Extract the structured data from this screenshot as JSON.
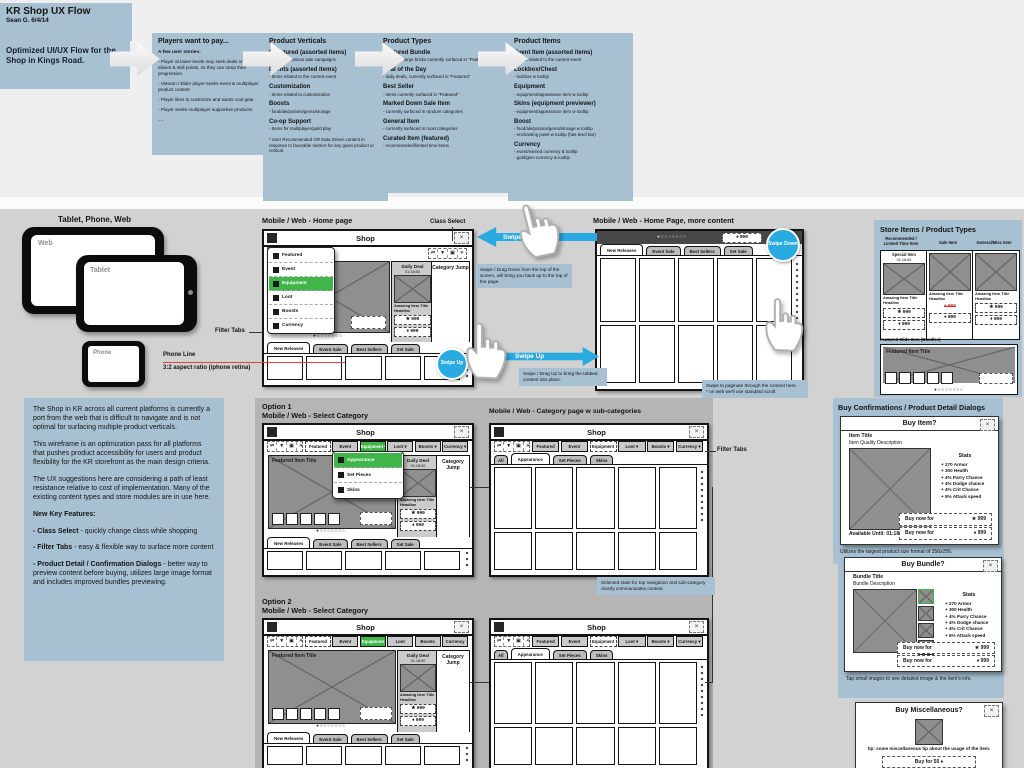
{
  "header": {
    "title": "KR Shop UX Flow",
    "byline": "Sean G.   6/4/14",
    "subtitle": "Optimized UI/UX Flow for the Shop in Kings Road."
  },
  "flow": {
    "players": {
      "heading": "Players want to pay...",
      "subheading": "A few user stories:",
      "stories": [
        "- Player at lower levels may seek deals on inventory, elixers & skill points, so they can ramp their progression.",
        "- Veteran / Elder player seeks event & multiplayer product content",
        "- Player likes to customize and wants cool gear",
        "- Player seeks multiplayer supportive products.",
        "....."
      ]
    },
    "verticals": {
      "heading": "Product Verticals",
      "entries": [
        {
          "title": "* Featured (assorted items)",
          "desc": "- Items for various sale campaigns"
        },
        {
          "title": "Events (assorted items)",
          "desc": "- Items related to the current event"
        },
        {
          "title": "Customization",
          "desc": "- Items related to customization"
        },
        {
          "title": "Boosts",
          "desc": "- food/ale/potions/gems/storage"
        },
        {
          "title": "Co-op Support",
          "desc": "- Items for multiplayer/guild play"
        }
      ],
      "footnote": "* User Recommended OR Data Driven content in response to favorable metrics for any given product or vertical."
    },
    "types": {
      "heading": "Product Types",
      "entries": [
        {
          "title": "Featured Bundle",
          "desc": "- Slides of large bricks currently surfaced in \"Featured\""
        },
        {
          "title": "Deal of the Day",
          "desc": "- daily deals, currently surfaced in \"Featured\""
        },
        {
          "title": "Best Seller",
          "desc": "- items currently surfaced in \"Featured\""
        },
        {
          "title": "Marked Down Sale Item",
          "desc": "- currently surfaced in random categories"
        },
        {
          "title": "General Item",
          "desc": "- currently surfaced in most categories"
        },
        {
          "title": "Curated Item (featured)",
          "desc": "- recommended/limited time items"
        }
      ]
    },
    "items": {
      "heading": "Product Items",
      "entries": [
        {
          "title": "Event Item (assorted items)",
          "desc": "- Items related to the current event"
        },
        {
          "title": "Lockbox/Chest",
          "desc": "- lockbox w tooltip"
        },
        {
          "title": "Equipment",
          "desc": "- equipment/appearance item w tooltip"
        },
        {
          "title": "Skins (equipment previewer)",
          "desc": "- equipment/appearance item w tooltip"
        },
        {
          "title": "Boost",
          "desc": "- food/ale/potions/gems/storage w tooltip\n- enchanting jewel w tooltip (has level bar)"
        },
        {
          "title": "Currency",
          "desc": "- event/earned currency & tooltip\n- gold/gem currency & tooltip"
        }
      ]
    }
  },
  "intro": {
    "p1": "The Shop in KR across all current platforms is currently a port from the web that is difficult to navigate and is not optimal for surfacing multiple product verticals.",
    "p2": "This wireframe is an optimization pass for all platforms that pushes product accessibility for users and product flexibility for the KR storefront as the main design criteria.",
    "p3": "The UX suggestions here are considering a path of least resistance relative to cost of implementation. Many of the existing content types and store modules are in use here.",
    "features_heading": "New Key Features:",
    "features": [
      {
        "head": "- Class Select",
        "rest": " - quickly change class while shopping"
      },
      {
        "head": "- Filter Tabs",
        "rest": " - easy & flexible way to surface more content"
      },
      {
        "head": "- Product Detail / Confirmation Dialogs",
        "rest": " - better way to preview content before buying, utilizes large image format and includes improved bundles previewing."
      }
    ]
  },
  "devices": {
    "heading": "Tablet, Phone, Web",
    "web": "Web",
    "tablet": "Tablet",
    "phone": "Phone"
  },
  "sections": {
    "homepage": "Mobile / Web - Home page",
    "more_content": "Mobile / Web - Home Page, more content",
    "option1": "Option 1",
    "option2": "Option 2",
    "select_category": "Mobile / Web - Select Category",
    "category_page": "Mobile / Web - Category page w sub-categories"
  },
  "annotations": {
    "class_select": "Class Select",
    "filter_tabs": "Filter Tabs",
    "phone_line": "Phone Line",
    "aspect_ratio": "3:2 aspect ratio (iphone retina)",
    "swipe_down": "Swipe Down",
    "swipe_up": "Swipe Up",
    "swipe_down_caption": "Swipe / Drag Down from the top of the screen, will bring you back up to the top of the page.",
    "swipe_up_caption": "Swipe / Drag Up to bring the tabbed content into place.",
    "paginate_caption": "Swipe to paginate through the content here.\n* on web we'll use standard scroll.",
    "selected_caption": "Selected state for top navigation and sub-category clearly communicates context."
  },
  "wireframe": {
    "shop": "Shop",
    "close": "×",
    "featured": "Featured",
    "category_jump": "Category Jump",
    "featured_item_title": "Featured Item Title",
    "daily_deal": "Daily Deal",
    "timer": "01:18:50",
    "amazing": "Amazing Item Title\nHeadline",
    "price_star": "★ 999",
    "price_gem": "♦ 999",
    "badge": "♦ 999",
    "dots": "●○○○○○○○",
    "caret": "▾",
    "filter_tabs": [
      "New Releases",
      "Event Sale",
      "Best Sellers",
      "Set Sale"
    ],
    "nav_tabs": [
      "Featured",
      "Event",
      "Equipment",
      "Loot",
      "Boosts",
      "Currency"
    ],
    "sub_tabs": [
      "All",
      "Appearance",
      "Set Pieces",
      "Skins"
    ],
    "equip_menu": [
      "Appearance",
      "Set Pieces",
      "Skins"
    ],
    "class_icons": [
      "⇄",
      "▼",
      "▣",
      "✳"
    ],
    "swipe_up_circle": "Swipe Up",
    "swipe_down_circle": "Swipe Down"
  },
  "store": {
    "heading": "Store Items / Product Types",
    "col_labels": [
      "Recommended /\nLimited Time Item",
      "Sale Item",
      "General/Misc Item"
    ],
    "special_item": "Special Item",
    "timer": "01:18:50",
    "item_title": "Amazing Item Title\nHeadline",
    "price_star": "★ 999",
    "price_gem": "♦ 999",
    "price_old": "♦ 999",
    "featured_label": "Featured Slide Item (Bundles)",
    "featured_title": "Featured Item Title",
    "dots": "●○○○○○○○"
  },
  "dialogs": {
    "heading": "Buy Confirmations / Product Detail Dialogs",
    "close": "×",
    "stats_heading": "Stats",
    "stats": [
      "+ 270 Armor",
      "+ 300 Health",
      "+ 4% Parry Chance",
      "+ 4% Dodge chance",
      "+ 4% Crit Chance",
      "+ 5% Attack speed"
    ],
    "buy_item": {
      "title": "Buy Item?",
      "item_title": "Item Title",
      "item_desc": "Item Quality Description",
      "available": "Available Until:  01:18:50",
      "buy_label": "Buy now for",
      "price_star": "★ 999",
      "price_gem": "♦ 999",
      "caption": "Utilizes the largest product size format of 256x256."
    },
    "buy_bundle": {
      "title": "Buy Bundle?",
      "item_title": "Bundle Title",
      "item_desc": "Bundle Description",
      "buy_label": "Buy now for",
      "price_star": "★ 999",
      "price_gem": "♦ 999",
      "caption": "Tap small images to see detailed image & the item's info."
    },
    "buy_misc": {
      "title": "Buy Miscellaneous?",
      "tip": "tip: some miscellaneous tip about the usage of the item.",
      "button": "Buy for 50 ♦"
    }
  }
}
